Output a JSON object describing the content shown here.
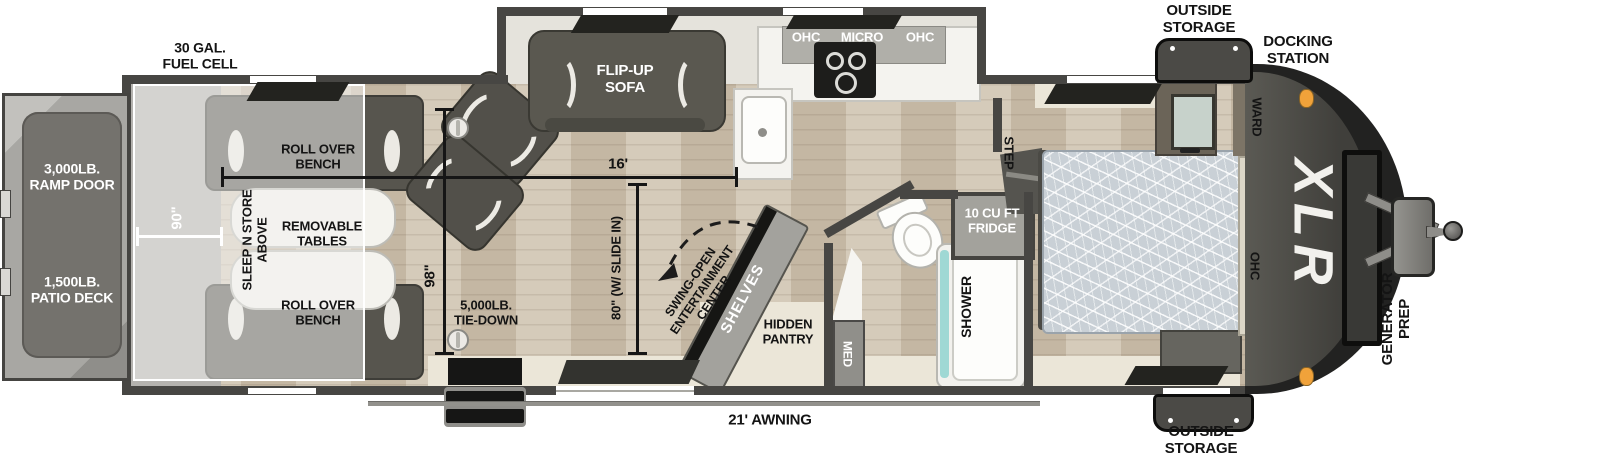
{
  "title": "XLR toy hauler travel trailer floor plan",
  "labels": {
    "fuel_cell": "30 GAL.\nFUEL CELL",
    "ramp_door": "3,000LB.\nRAMP DOOR",
    "patio_deck": "1,500LB.\nPATIO DECK",
    "roll_over_bench_top": "ROLL OVER\nBENCH",
    "roll_over_bench_bottom": "ROLL OVER\nBENCH",
    "removable_tables": "REMOVABLE\nTABLES",
    "sleep_n_store": "SLEEP N STORE\nABOVE",
    "tie_down": "5,000LB.\nTIE-DOWN",
    "flip_up_sofa": "FLIP-UP\nSOFA",
    "ohc_left": "OHC",
    "micro": "MICRO",
    "ohc_right": "OHC",
    "swing_open_entertainment": "SWING-OPEN\nENTERTAINMENT\nCENTER",
    "shelves": "SHELVES",
    "hidden_pantry": "HIDDEN\nPANTRY",
    "med": "MED",
    "shower": "SHOWER",
    "fridge": "10 CU FT\nFRIDGE",
    "step": "STEP",
    "ward": "WARD",
    "bedroom_ohc": "OHC",
    "outside_storage_top": "OUTSIDE\nSTORAGE",
    "outside_storage_bottom": "OUTSIDE\nSTORAGE",
    "docking_station": "DOCKING\nSTATION",
    "xlr_logo": "XLR",
    "generator_prep": "GENERATOR\nPREP",
    "awning": "21' AWNING"
  },
  "dimensions": {
    "garage_width": "90\"",
    "garage_length": "16'",
    "interior_width": "98\"",
    "slide_width": "80\" (W/ SLIDE IN)"
  },
  "colors": {
    "wall": "#474643",
    "wood_floor": "#cfc4b1",
    "cream_floor": "#ebe6d8",
    "front_cap": "#2b2b2a",
    "marker_light": "#f0a23a",
    "dimension_dark": "#161616",
    "dimension_white": "#ffffff"
  }
}
